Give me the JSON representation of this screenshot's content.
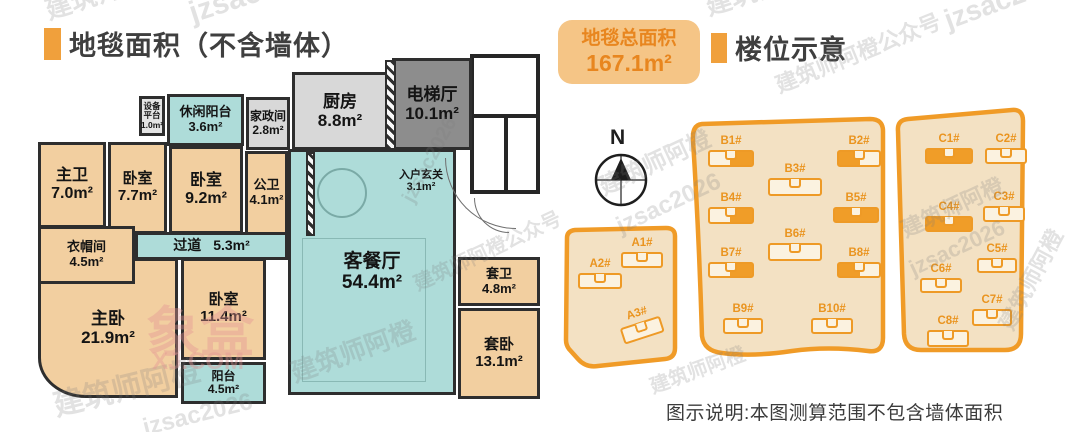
{
  "left_panel": {
    "title": "地毯面积（不含墙体）",
    "rooms": {
      "equipment_platform": {
        "name": "设备平台",
        "area": "1.0m²"
      },
      "leisure_balcony": {
        "name": "休闲阳台",
        "area": "3.6m²"
      },
      "housekeeping": {
        "name": "家政间",
        "area": "2.8m²"
      },
      "kitchen": {
        "name": "厨房",
        "area": "8.8m²"
      },
      "elevator_hall": {
        "name": "电梯厅",
        "area": "10.1m²"
      },
      "master_bath": {
        "name": "主卫",
        "area": "7.0m²"
      },
      "bedroom_a": {
        "name": "卧室",
        "area": "7.7m²"
      },
      "bedroom_b": {
        "name": "卧室",
        "area": "9.2m²"
      },
      "guest_bath": {
        "name": "公卫",
        "area": "4.1m²"
      },
      "foyer": {
        "name": "入户玄关",
        "area": "3.1m²"
      },
      "living_dining": {
        "name": "客餐厅",
        "area": "54.4m²"
      },
      "corridor": {
        "name": "过道",
        "area": "5.3m²"
      },
      "cloakroom": {
        "name": "衣帽间",
        "area": "4.5m²"
      },
      "master_bedroom": {
        "name": "主卧",
        "area": "21.9m²"
      },
      "bedroom_c": {
        "name": "卧室",
        "area": "11.4m²"
      },
      "balcony": {
        "name": "阳台",
        "area": "4.5m²"
      },
      "suite_bath": {
        "name": "套卫",
        "area": "4.8m²"
      },
      "suite_bedroom": {
        "name": "套卧",
        "area": "13.1m²"
      }
    }
  },
  "total_badge": {
    "label": "地毯总面积",
    "value": "167.1m²"
  },
  "right_panel": {
    "title": "楼位示意",
    "compass_label": "N",
    "buildings": {
      "A1": {
        "label": "A1#",
        "highlight": "none"
      },
      "A2": {
        "label": "A2#",
        "highlight": "none"
      },
      "A3": {
        "label": "A3#",
        "highlight": "none"
      },
      "B1": {
        "label": "B1#",
        "highlight": "right"
      },
      "B2": {
        "label": "B2#",
        "highlight": "left"
      },
      "B3": {
        "label": "B3#",
        "highlight": "none"
      },
      "B4": {
        "label": "B4#",
        "highlight": "right"
      },
      "B5": {
        "label": "B5#",
        "highlight": "full"
      },
      "B6": {
        "label": "B6#",
        "highlight": "none"
      },
      "B7": {
        "label": "B7#",
        "highlight": "right"
      },
      "B8": {
        "label": "B8#",
        "highlight": "left"
      },
      "B9": {
        "label": "B9#",
        "highlight": "none"
      },
      "B10": {
        "label": "B10#",
        "highlight": "none"
      },
      "C1": {
        "label": "C1#",
        "highlight": "full"
      },
      "C2": {
        "label": "C2#",
        "highlight": "none"
      },
      "C3": {
        "label": "C3#",
        "highlight": "none"
      },
      "C4": {
        "label": "C4#",
        "highlight": "full"
      },
      "C5": {
        "label": "C5#",
        "highlight": "none"
      },
      "C6": {
        "label": "C6#",
        "highlight": "none"
      },
      "C7": {
        "label": "C7#",
        "highlight": "none"
      },
      "C8": {
        "label": "C8#",
        "highlight": "none"
      }
    }
  },
  "footnote": "图示说明:本图测算范围不包含墙体面积",
  "watermarks": [
    "建筑师阿橙",
    "jzsac2026",
    "建筑师阿橙",
    "jzsac2026",
    "建筑师阿橙公众号",
    "建筑师阿橙",
    "jzsac2026",
    "建筑师阿橙",
    "jzsac2026",
    "建筑师阿橙",
    "建筑师阿橙",
    "jzsac2026",
    "建筑师阿橙",
    "建筑师阿橙公众号",
    "象盒",
    "XJ.COM",
    "jzsac2026",
    "建筑师阿橙"
  ],
  "colors": {
    "accent_orange": "#f0a03c",
    "parcel_stroke": "#f09b27",
    "parcel_fill": "#f3e1c3",
    "room_teal": "#aedcd9",
    "room_tan": "#f2cfa0",
    "room_gray": "#d8d8d8",
    "elevator_gray": "#8d8d8d",
    "badge_bg": "#f5c586",
    "badge_text": "#e8861f"
  }
}
